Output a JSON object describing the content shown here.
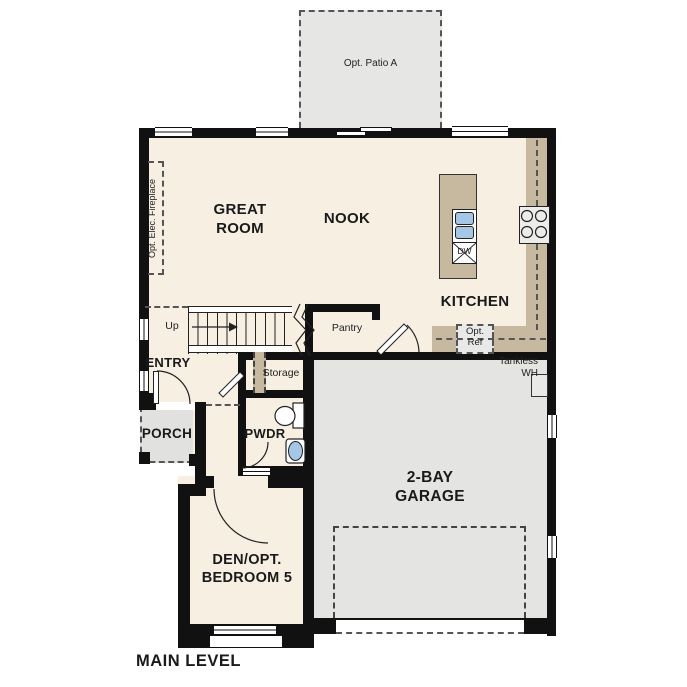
{
  "title": "MAIN LEVEL",
  "rooms": {
    "great_room": "GREAT\nROOM",
    "nook": "NOOK",
    "kitchen": "KITCHEN",
    "pantry": "Pantry",
    "storage": "Storage",
    "entry": "ENTRY",
    "porch": "PORCH",
    "powder": "PWDR",
    "den": "DEN/OPT.\nBEDROOM 5",
    "garage": "2-BAY\nGARAGE"
  },
  "annotations": {
    "patio": "Opt. Patio A",
    "fireplace": "Opt. Elec. Fireplace",
    "stairs_up": "Up",
    "tankless_wh": "Tankless\nWH",
    "opt_ref": "Opt.\nRef",
    "dishwasher": "DW"
  },
  "colors": {
    "floor": "#f6efe2",
    "counter": "#c7b9a0",
    "garage_floor": "#e4e4e2",
    "patio": "#e6e6e4",
    "porch": "#e1e1df",
    "wall": "#111111",
    "sink_blue": "#a5c6e5",
    "appliance": "#ececea"
  }
}
